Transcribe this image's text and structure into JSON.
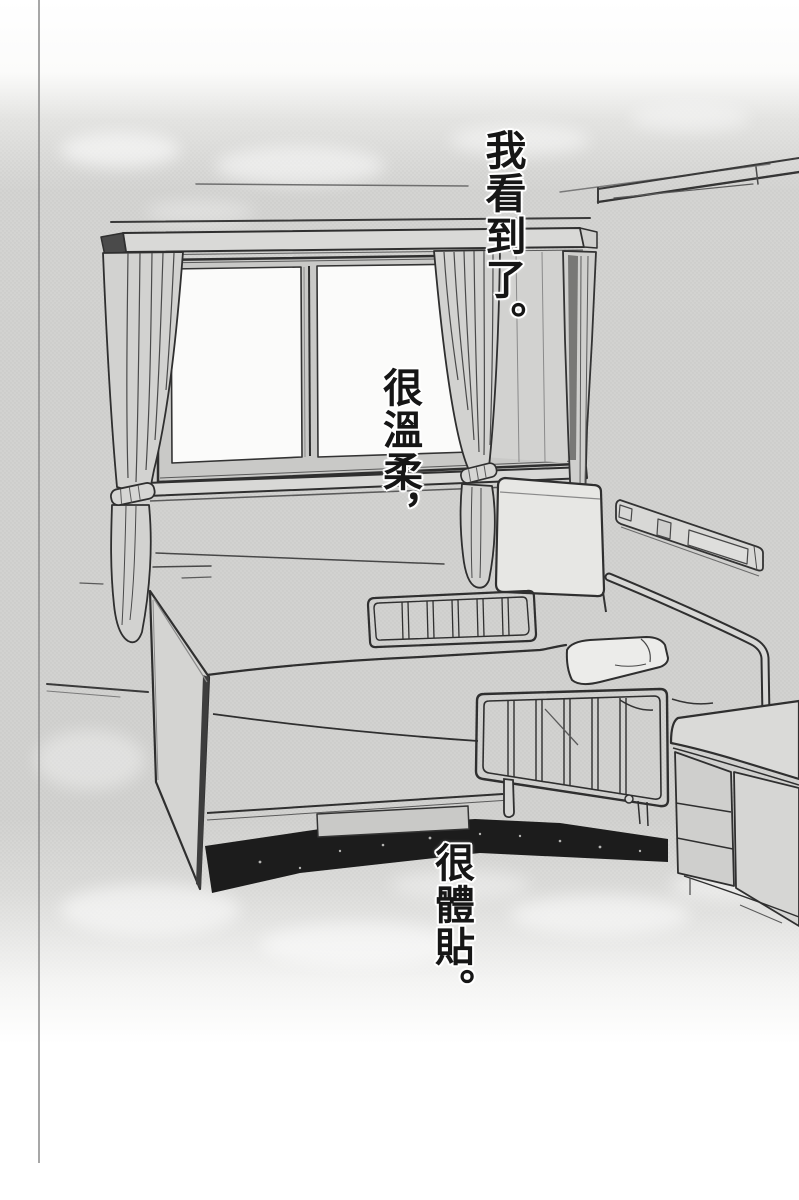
{
  "page": {
    "captions": [
      {
        "id": "caption-top-right",
        "text": "我看到了。"
      },
      {
        "id": "caption-middle",
        "text": "很溫柔，"
      },
      {
        "id": "caption-bottom",
        "text": "很體貼。"
      }
    ],
    "colors": {
      "paper": "#ffffff",
      "halftone_wall": "#d2d2d0",
      "ink": "#2f2f2f",
      "under_bed_shadow": "#1c1c1c",
      "window_light": "#fbfbfa"
    },
    "objects": [
      "window-two-panes",
      "curtain-valance",
      "left-curtain-tied",
      "right-curtain-tied",
      "hospital-bed",
      "bed-side-rails",
      "headboard-panel",
      "pillow",
      "wall-rail",
      "nightstand-drawers"
    ]
  }
}
